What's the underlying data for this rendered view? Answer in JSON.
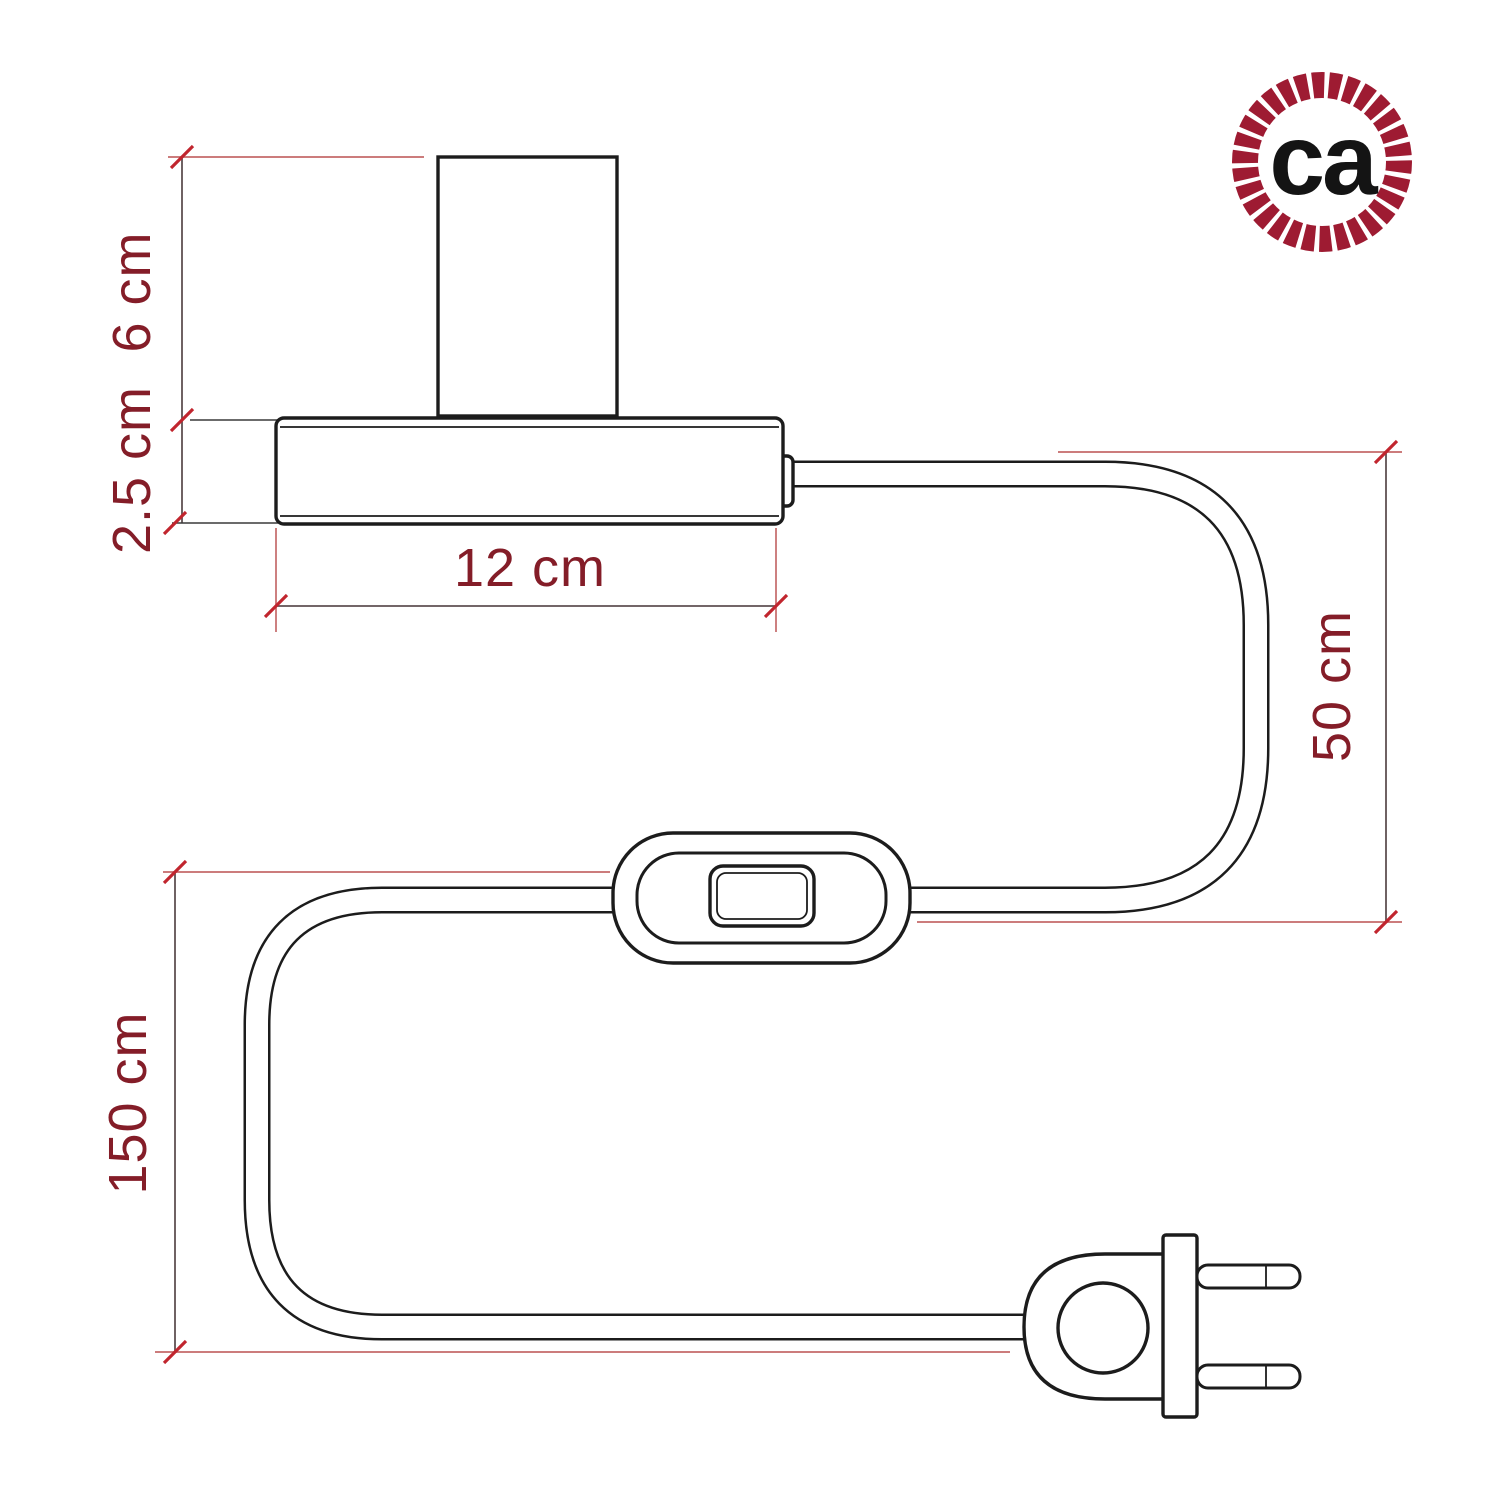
{
  "page": {
    "background": "#ffffff"
  },
  "colors": {
    "drawing_line": "#1c1c1c",
    "dimension_line": "#5f5052",
    "extension_line_red": "#c46a6a",
    "extension_line_dark": "#3a3a3a",
    "tick_red": "#c1252e",
    "dimension_text": "#841d28",
    "logo_ring_red": "#9e1b32",
    "logo_text_black": "#141414"
  },
  "diagram": {
    "type": "technical-dimension-drawing",
    "subject": "table lamp with power cable, inline switch and two-pin plug",
    "parts": {
      "lamp_holder": "lamp-holder-cylinder",
      "lamp_base": "lamp-base",
      "cable": "power-cable",
      "switch": "inline-switch",
      "plug": "two-pin-plug"
    },
    "dims": {
      "holder_height": {
        "label": "6 cm",
        "orientation": "vertical"
      },
      "base_height": {
        "label": "2.5 cm",
        "orientation": "vertical"
      },
      "base_width": {
        "label": "12 cm",
        "orientation": "horizontal"
      },
      "lamp_to_switch": {
        "label": "50 cm",
        "orientation": "vertical"
      },
      "switch_to_plug": {
        "label": "150 cm",
        "orientation": "vertical"
      }
    }
  },
  "logo": {
    "text": "ca"
  }
}
